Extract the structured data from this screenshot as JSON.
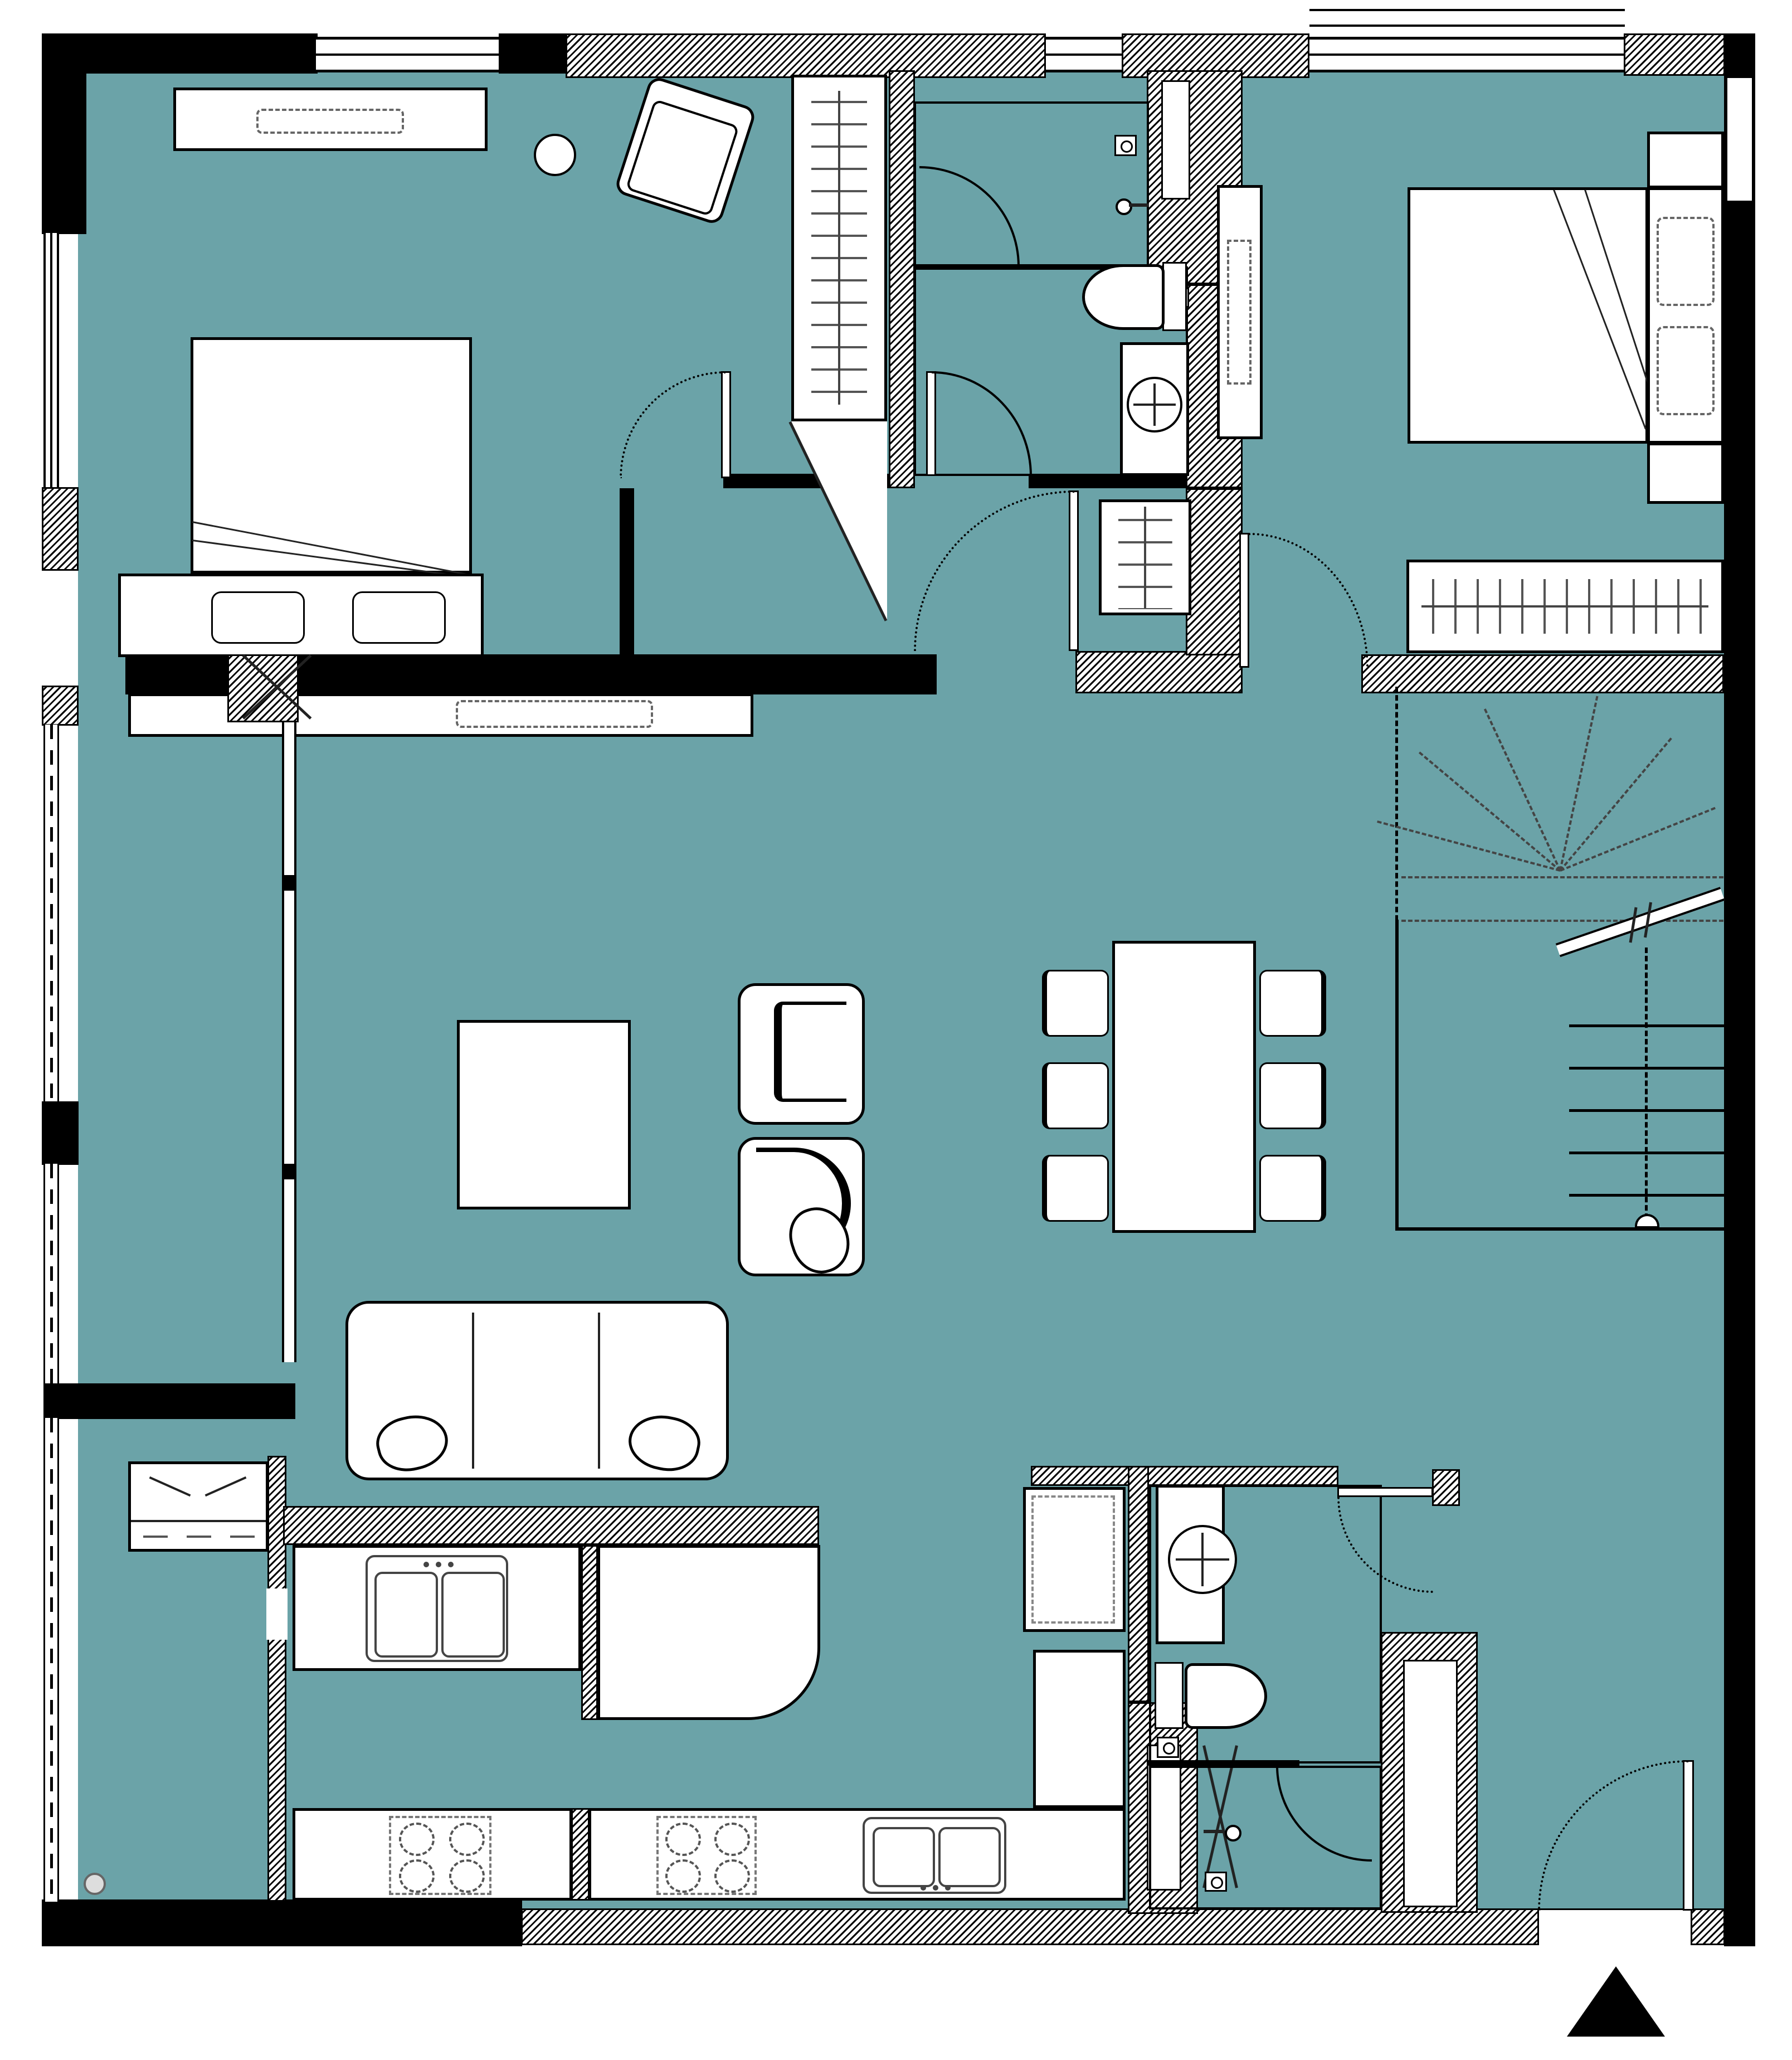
{
  "palette": {
    "floor_teal": "#6BA3A8",
    "wall_black": "#000000",
    "fixture_white": "#FFFFFF",
    "detail_gray": "#555555"
  },
  "plan": {
    "title": "Apartment floor plan (no text labels in drawing)",
    "north_marker": "solid black triangle pointing up, bottom right"
  },
  "rooms": {
    "bedroom1": "Bedroom 1 (top left)",
    "bedroom2": "Bedroom 2 (top right)",
    "bathroom1": "Bathroom with shower and WC (top middle)",
    "corridor": "Bedroom corridor with coat closet",
    "living": "Living room",
    "dining": "Dining area",
    "stairs": "Staircase to other level",
    "kitchen": "Kitchen",
    "bathroom2": "Second bathroom (bottom)",
    "entry": "Entry hall (bottom right)",
    "balcony_upper": "Side loggia / balcony strip (upper)",
    "balcony_lower": "Side loggia / utility strip (lower)"
  },
  "furniture": {
    "bed1": "Double bed with pillows and blanket",
    "bed2": "Double bed with pillows and blanket",
    "dresser1": "Dresser with TV (dashed)",
    "stool1": "Round stool",
    "armchair_tilted": "Tilted armchair",
    "wardrobe1": "Wardrobe with clothes hangers (angled end)",
    "wardrobe2": "Wardrobe with clothes hangers",
    "coat_closet": "Coat closet with hangers",
    "tv_console": "TV console with TV (dashed)",
    "tv_cabinet2": "TV cabinet (dashed TV)",
    "coffee_table": "Square coffee table",
    "armchair_a": "Armchair, open side",
    "armchair_b": "Armchair with round cushion",
    "sofa": "Three-seat sofa with pillows",
    "dining_table": "Dining table for six",
    "dining_chairs": "6 dining chairs (3 left, 3 right)",
    "cabinet_laundry": "Cabinet with double doors and drawers",
    "fridge": "Refrigerator (dashed doors)",
    "tall_cabinet": "Tall kitchen cabinet"
  },
  "fixtures": {
    "kitchen_sink_upper": "Double-bowl sink, upper counter",
    "kitchen_sink_lower": "Double-bowl sink, lower counter",
    "cooktop1": "4-burner cooktop (left)",
    "cooktop2": "4-burner cooktop (right)",
    "toilet1": "Toilet, top bathroom",
    "toilet2": "Toilet, bottom bathroom",
    "washbasin1": "Round washbasin on counter, top bathroom",
    "washbasin2": "Round washbasin on counter, bottom bathroom",
    "shower1": "Shower corner with glass door and floor drain",
    "shower2": "Shower corner with door and floor drain",
    "floor_drains": "4 small square floor drains + 1 round drain",
    "ducts": "Service shafts with X symbol (3)",
    "column": "Structural column with X (1)"
  },
  "doors": {
    "entry_door": "Entry door, bottom-right, swings in",
    "bedroom1_door": "Bedroom 1 door",
    "bedroom2_door": "Bedroom 2 door",
    "corridor_door": "Corridor door from living room",
    "bathroom1_door": "Top bathroom door",
    "bathroom2_door": "Bottom bathroom door",
    "glass_partition": "Glazed partition to balcony strip with sliding panel"
  }
}
